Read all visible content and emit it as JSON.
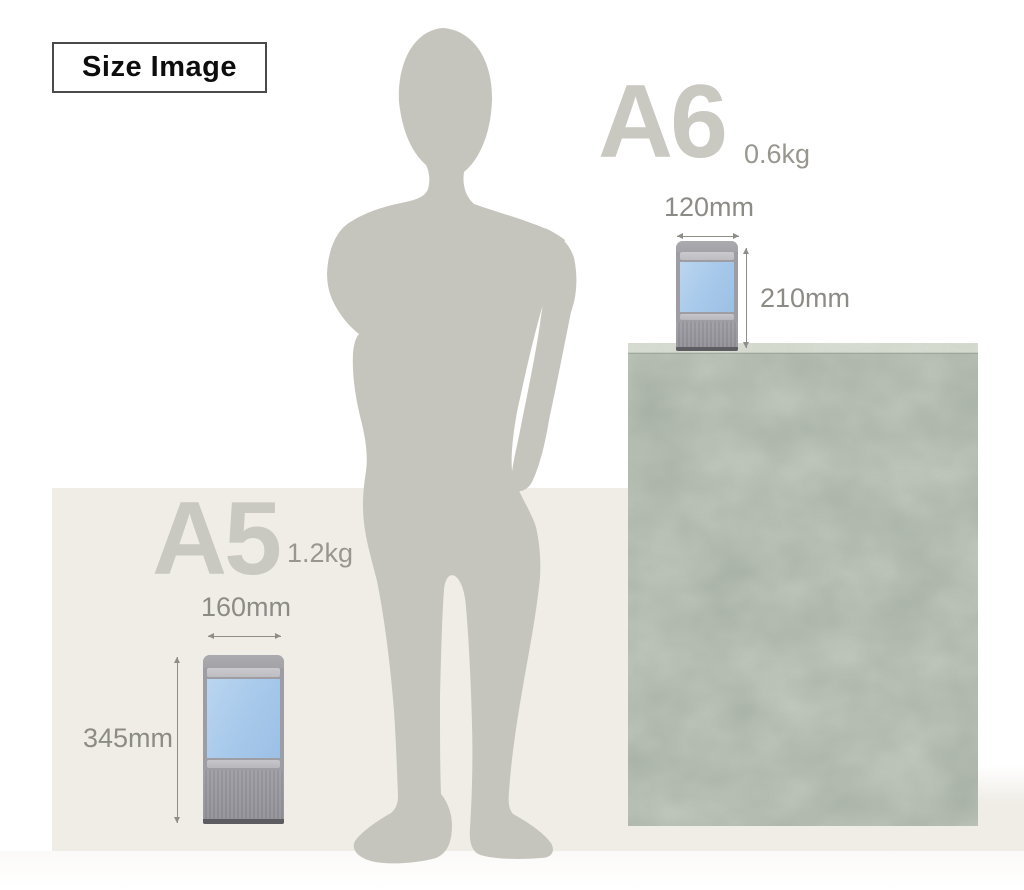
{
  "badge": {
    "label": "Size Image"
  },
  "products": [
    {
      "name": "A6",
      "weight": "0.6kg",
      "width": "120mm",
      "height": "210mm"
    },
    {
      "name": "A5",
      "weight": "1.2kg",
      "width": "160mm",
      "height": "345mm"
    }
  ],
  "colors": {
    "floor": "#f0ede7",
    "silhouette": "#c6c5bd",
    "counter_front": "#a7b0a4",
    "counter_top": "#d2d8cb",
    "screen_blue": "#a6c8ea",
    "device_gray": "#9d9da3",
    "product_name_text": "#c9c8c1",
    "dimension_text": "#8c8b86",
    "badge_border": "#4a4a4a"
  }
}
